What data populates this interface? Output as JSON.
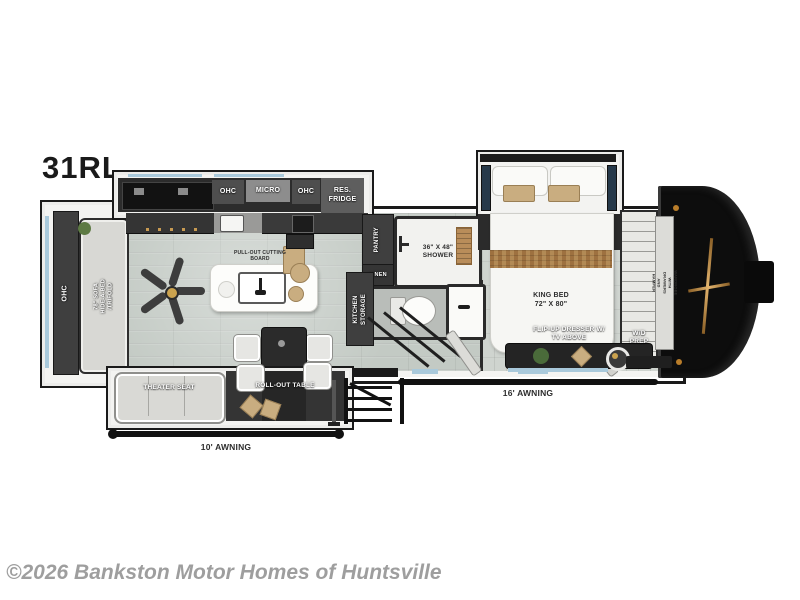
{
  "title": "31RL",
  "watermark": "©2026 Bankston Motor Homes of Huntsville",
  "colors": {
    "wall": "#1a1a1a",
    "floor_living": "#c3cac4",
    "floor_bedroom": "#cfd4cf",
    "window_accent": "#a9c9db",
    "tan_accent": "#c9ad80",
    "front_cap": "#0d0d0d",
    "cap_logo_gold": "#c79a52",
    "watermark_gray": "#9e9e9e"
  },
  "labels": {
    "ohc_rear": "OHC",
    "sofa": "78\" SOFA\nHIDE-A-BED\n/TRIFOLD",
    "ohc_left": "OHC",
    "micro": "MICRO",
    "ohc_right": "OHC",
    "res_fridge": "RES.\nFRIDGE",
    "pull_out_cutting_board": "PULL-OUT CUTTING\nBOARD",
    "pantry": "PANTRY",
    "linen": "LINEN",
    "shower": "36\" X 48\"\nSHOWER",
    "kitchen_storage": "KITCHEN\nSTORAGE",
    "king_bed": "KING BED\n72\" X 80\"",
    "wardrobe": "WARDROBE\nWITH DRAWERS AND HAMPER",
    "flip_up_dresser": "FLIP-UP DRESSER W/\nTV ABOVE",
    "wd_prep": "W/D\nPREP",
    "theater_seat": "THEATER SEAT",
    "roll_out_table": "ROLL-OUT TABLE",
    "awning_16": "16' AWNING",
    "awning_10": "10' AWNING"
  }
}
